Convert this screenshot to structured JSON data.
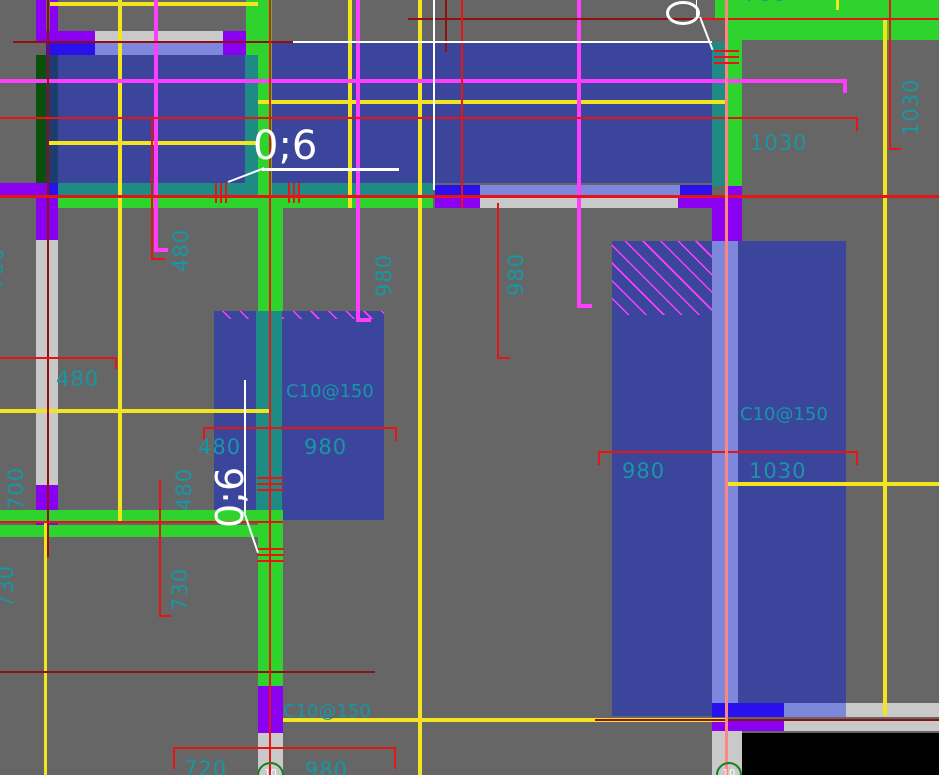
{
  "drawing": {
    "type": "structural-cad-rebar-plan",
    "callouts": {
      "top": "0;6",
      "middle": "0;6",
      "ellipse_digit": "0"
    },
    "rebar_labels": [
      "C10@150",
      "C10@150",
      "C10@150"
    ],
    "grid_bubble_label": "10"
  },
  "labels": [
    "700",
    "480",
    "1030",
    "1030",
    "700",
    "980",
    "980",
    "480",
    "700",
    "480",
    "480",
    "980",
    "C10@150",
    "980",
    "1030",
    "C10@150",
    "730",
    "730",
    "C10@150",
    "720",
    "980",
    "0;6",
    "0;6",
    "10",
    "10"
  ],
  "colors": {
    "background": "#666666",
    "slab_blue": "#3c459c",
    "wall_green": "#2ed32e",
    "wall_teal": "#1e8c84",
    "wall_purple": "#8a00f0",
    "wall_gray": "#c9c9c9",
    "wall_periwinkle": "#7d88dd",
    "wall_royal_blue": "#2b10ee",
    "dim_red": "#e81414",
    "dark_red": "#8f1010",
    "grid_yellow": "#f2e41f",
    "axis_magenta": "#ff3dff",
    "text_cyan": "#1797a3",
    "callout_white": "#ffffff",
    "salmon_line": "#ff8585",
    "dark_green": "#0a4f0a",
    "navy_strip": "#1b3e6e",
    "void_black": "#000000",
    "bubble_green": "#15821c"
  }
}
